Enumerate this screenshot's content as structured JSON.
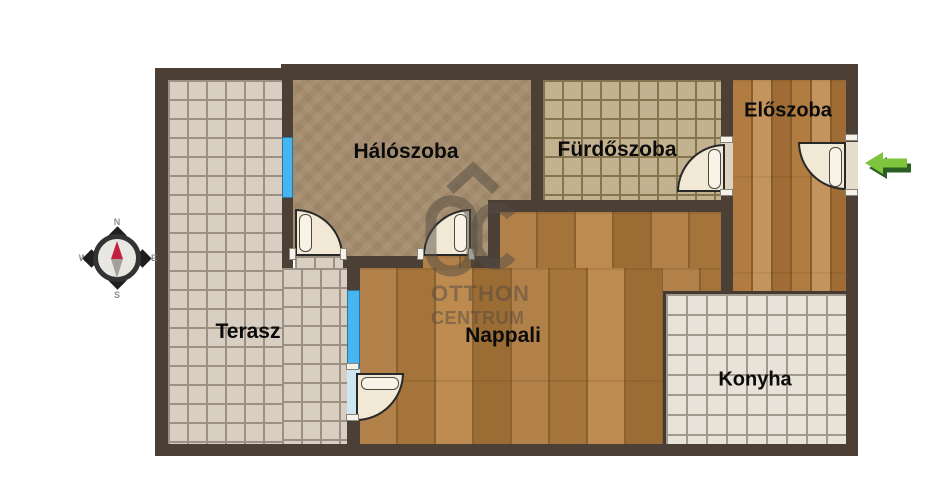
{
  "plan": {
    "rooms": {
      "terasz": {
        "label": "Terasz"
      },
      "haloszoba": {
        "label": "Hálószoba"
      },
      "furdoszoba": {
        "label": "Fürdőszoba"
      },
      "eloszoba": {
        "label": "Előszoba"
      },
      "nappali": {
        "label": "Nappali"
      },
      "konyha": {
        "label": "Konyha"
      }
    },
    "compass": {
      "north": "N",
      "east": "E",
      "south": "S",
      "west": "W"
    },
    "watermark": {
      "brand_line1": "OTTHON",
      "brand_line2": "CENTRUM"
    },
    "colors": {
      "wall": "#4b3f36",
      "window_blue": "#47b6f0",
      "entrance_arrow_light": "#7fc43d",
      "entrance_arrow_dark": "#2a5e23",
      "compass_needle_red": "#c51f3f"
    }
  }
}
